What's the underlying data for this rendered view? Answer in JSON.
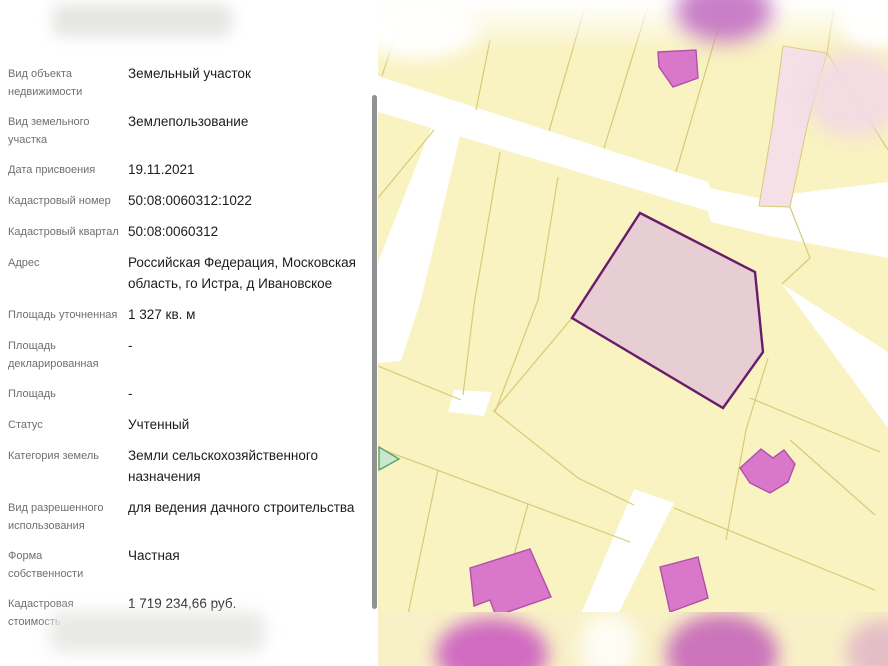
{
  "panel": {
    "fields": [
      {
        "label": "Вид объекта недвижимости",
        "value": "Земельный участок"
      },
      {
        "label": "Вид земельного участка",
        "value": "Землепользование"
      },
      {
        "label": "Дата присвоения",
        "value": "19.11.2021"
      },
      {
        "label": "Кадастровый номер",
        "value": "50:08:0060312:1022"
      },
      {
        "label": "Кадастровый квартал",
        "value": "50:08:0060312"
      },
      {
        "label": "Адрес",
        "value": "Российская Федерация, Московская область, го Истра, д Ивановское"
      },
      {
        "label": "Площадь уточненная",
        "value": "1 327 кв. м"
      },
      {
        "label": "Площадь декларированная",
        "value": "-"
      },
      {
        "label": "Площадь",
        "value": "-"
      },
      {
        "label": "Статус",
        "value": "Учтенный"
      },
      {
        "label": "Категория земель",
        "value": "Земли сельскохозяйственного назначения"
      },
      {
        "label": "Вид разрешенного использования",
        "value": "для ведения дачного строительства"
      },
      {
        "label": "Форма собственности",
        "value": "Частная"
      },
      {
        "label": "Кадастровая стоимость",
        "value": "1 719 234,66 руб."
      }
    ]
  },
  "map": {
    "colors": {
      "parcel_fill": "#F9F2C1",
      "parcel_border": "#D8CA76",
      "road": "#FFFFFF",
      "selected_parcel_fill": "#E7CDD4",
      "selected_parcel_border": "#6A1C68",
      "building_fill": "#D977CA",
      "building_border": "#B14FA8",
      "zone_strip_fill": "#F5E0E8",
      "green_marker_fill": "#C8E7CE",
      "green_marker_border": "#55A46A"
    }
  }
}
